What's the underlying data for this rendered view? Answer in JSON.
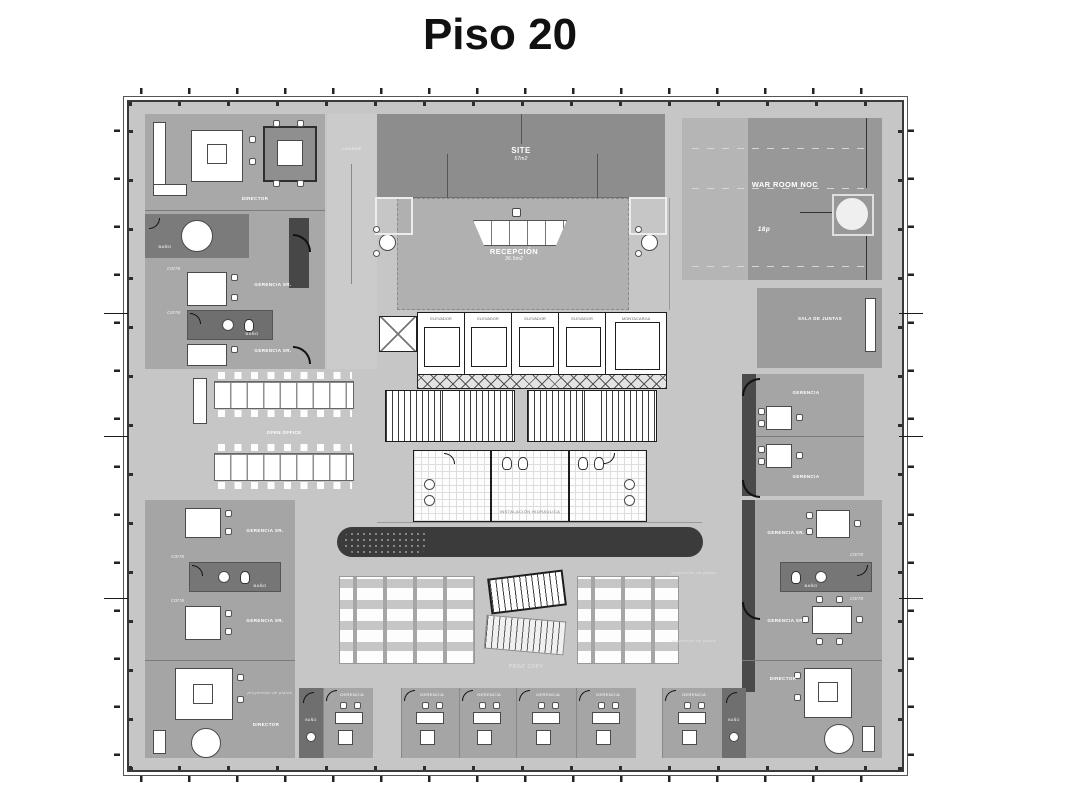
{
  "title": "Piso 20",
  "rooms": {
    "site": {
      "label": "SITE",
      "area": "57m2"
    },
    "recepcion": {
      "label": "RECEPCIÓN",
      "area": "36.5m2"
    },
    "war_room": {
      "label": "WAR ROOM NOC",
      "capacity": "18p"
    },
    "sala_juntas": {
      "label": "SALA DE JUNTAS"
    },
    "lounge": {
      "label": "LOUNGE"
    },
    "open_office": {
      "label": "OPEN OFFICE"
    },
    "director": {
      "label": "DIRECTOR"
    },
    "gerencia": {
      "label": "GERENCIA"
    },
    "gerencia_sr": {
      "label": "GERENCIA SR."
    },
    "bano": {
      "label": "BAÑO"
    },
    "elevador": {
      "label": "ELEVADOR"
    },
    "montacarga": {
      "label": "MONTACARGA"
    },
    "print_copy": {
      "label": "PRINT COPY"
    },
    "corredor": {
      "label": "corre"
    },
    "proyeccion": {
      "label": "proyección de plafón"
    },
    "instalaciones": {
      "label": "INSTALACIÓN HIDRÁULICA"
    }
  },
  "colors": {
    "background": "#ffffff",
    "field": "#c6c6c6",
    "office_block": "#a5a5a5",
    "dark_room": "#8d8d8d",
    "accent_wall": "#4a4a4a",
    "dark_bar": "#3b3b3b",
    "line": "#1d1d1d",
    "text": "#ffffff"
  }
}
